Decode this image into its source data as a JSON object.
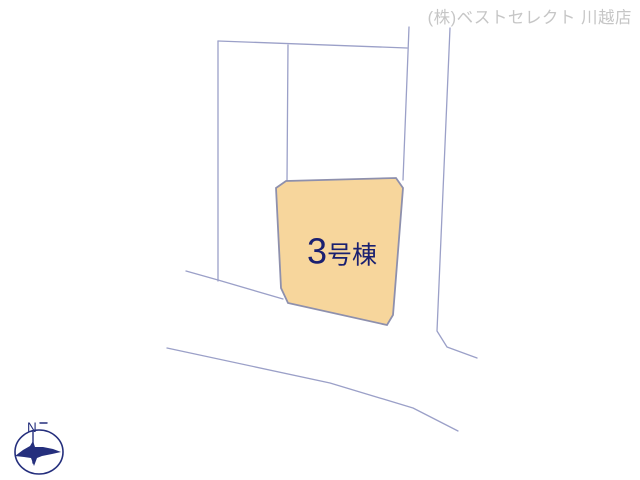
{
  "header": {
    "company_label": "(株)ベストセレクト 川越店"
  },
  "lot": {
    "number": "3",
    "suffix": "号棟",
    "label": "3号棟"
  },
  "compass": {
    "north_label": "N"
  },
  "colors": {
    "lot_fill": "#f7d69c",
    "lot_border": "#8e90ad",
    "boundary_line": "#9ba0c8",
    "lot_text": "#1a2070",
    "company_text": "#c6c6c6",
    "compass": "#252f7d"
  }
}
